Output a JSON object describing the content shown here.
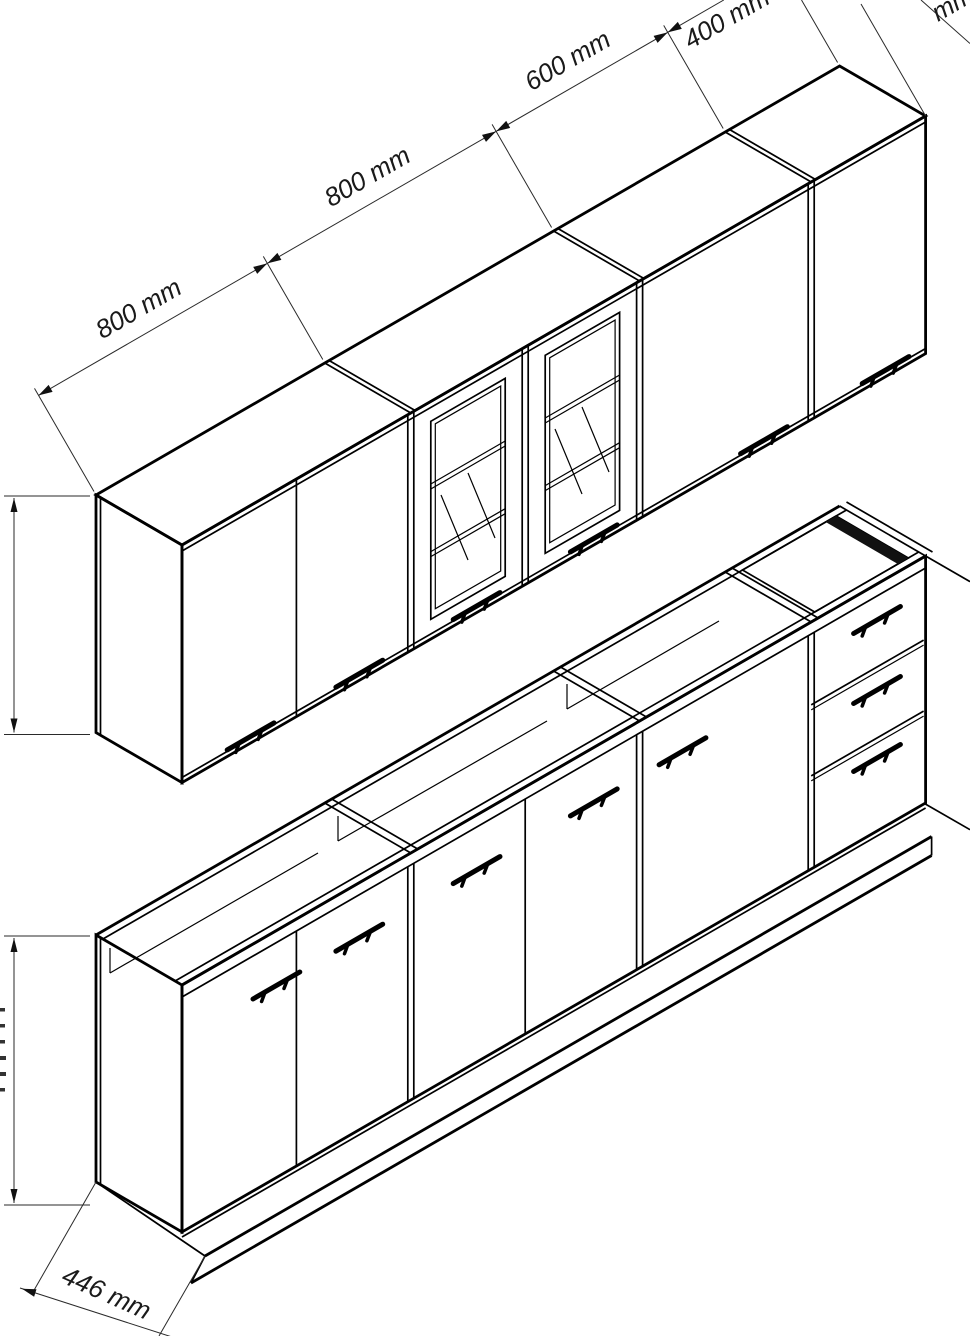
{
  "drawing": {
    "background_color": "#ffffff",
    "line_color": "#000000",
    "label_color": "#1a1a1a",
    "labels": {
      "wall_widths": [
        "800 mm",
        "800 mm",
        "600 mm",
        "400 mm"
      ],
      "base_depth": "446 mm",
      "clipped_top_right": "mm"
    }
  }
}
